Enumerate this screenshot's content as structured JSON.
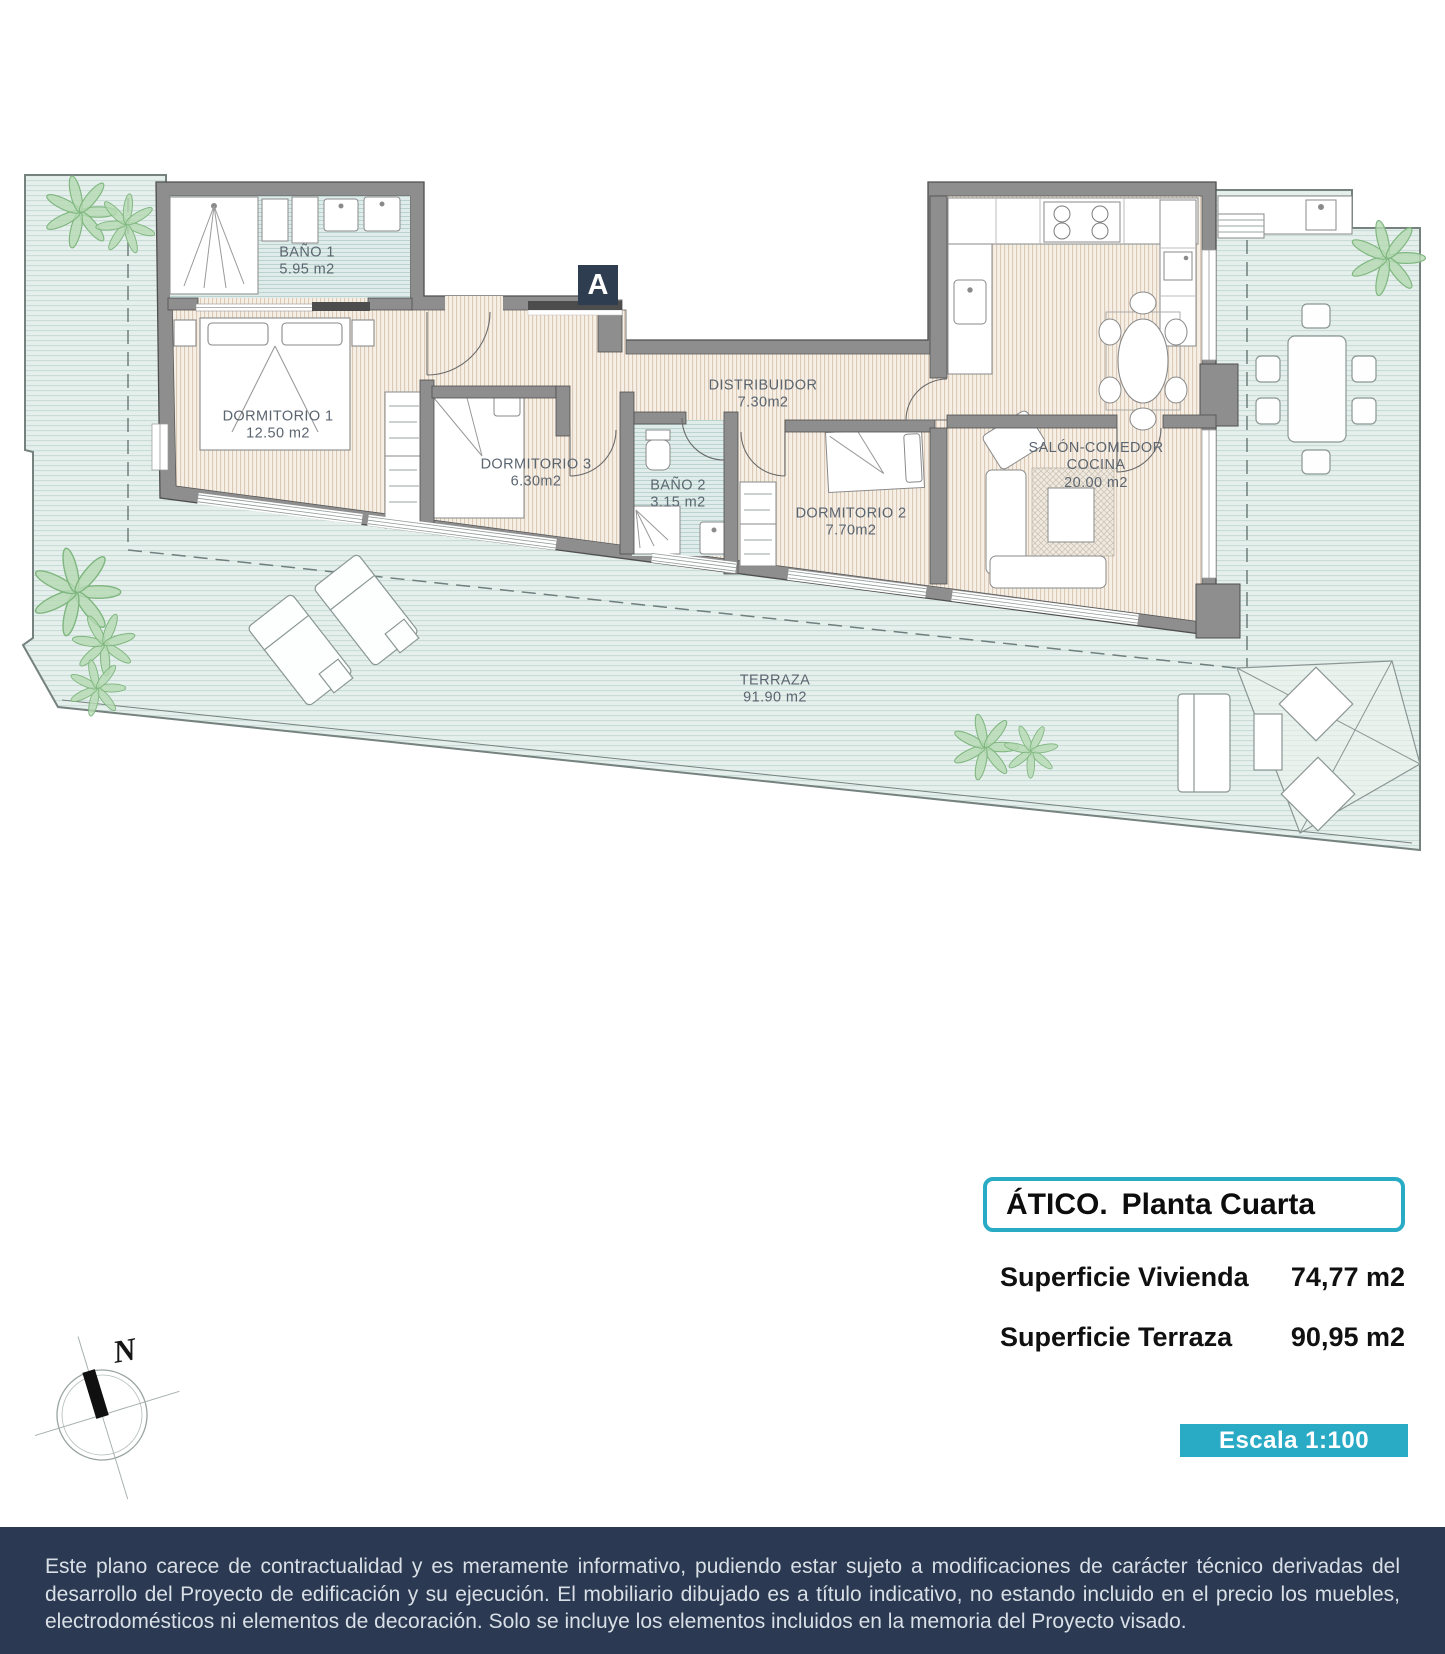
{
  "plan": {
    "section_marker": "A",
    "compass_label": "N",
    "rooms": [
      {
        "id": "bano1",
        "name": "BAÑO 1",
        "area": "5.95 m2"
      },
      {
        "id": "dormitorio1",
        "name": "DORMITORIO 1",
        "area": "12.50 m2"
      },
      {
        "id": "dormitorio3",
        "name": "DORMITORIO 3",
        "area": "6.30m2"
      },
      {
        "id": "bano2",
        "name": "BAÑO 2",
        "area": "3.15 m2"
      },
      {
        "id": "distribuidor",
        "name": "DISTRIBUIDOR",
        "area": "7.30m2"
      },
      {
        "id": "dormitorio2",
        "name": "DORMITORIO 2",
        "area": "7.70m2"
      },
      {
        "id": "salon",
        "name": "SALÓN-COMEDOR",
        "name2": "COCINA",
        "area": "20.00 m2"
      },
      {
        "id": "terraza",
        "name": "TERRAZA",
        "area": "91.90 m2"
      }
    ]
  },
  "title_block": {
    "title_prefix": "ÁTICO.",
    "title_name": "Planta Cuarta",
    "rows": [
      {
        "label": "Superficie Vivienda",
        "value": "74,77 m2"
      },
      {
        "label": "Superficie Terraza",
        "value": "90,95 m2"
      }
    ],
    "scale_label": "Escala 1:100"
  },
  "footer": {
    "disclaimer": "Este plano carece de contractualidad y es meramente informativo, pudiendo estar sujeto a modificaciones de carácter técnico derivadas del desarrollo del Proyecto de edificación y su ejecución. El mobiliario dibujado es a título indicativo, no estando incluido en el precio los muebles, electrodomésticos ni elementos de decoración. Solo se incluye los elementos incluidos en la memoria del Proyecto visado.",
    "colors": {
      "accent": "#29aac5",
      "footer_bg": "#2b3a52",
      "marker_bg": "#2e3d50"
    }
  }
}
